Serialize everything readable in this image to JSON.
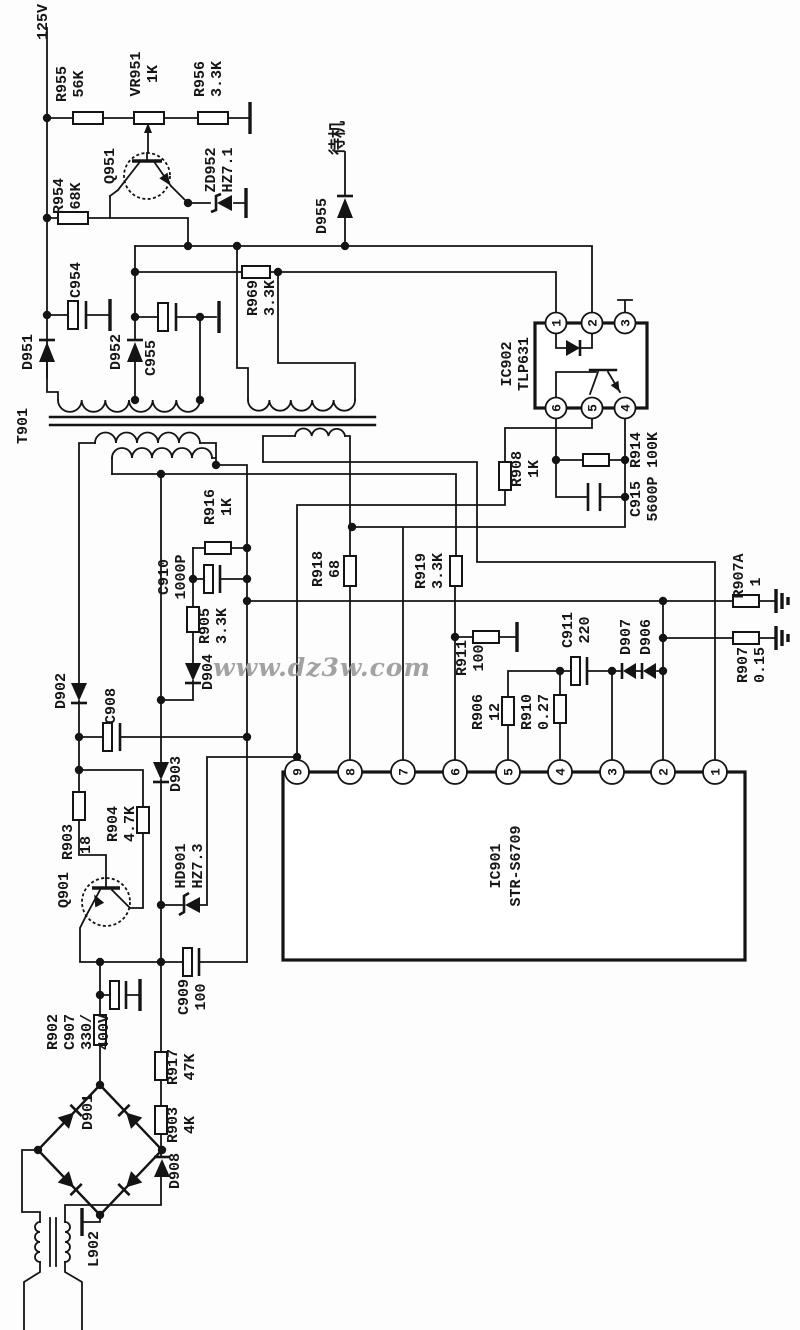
{
  "watermark": "www.dz3w.com",
  "ic901": {
    "name": "IC901",
    "part": "STR-S6709",
    "pins": [
      "9",
      "8",
      "7",
      "6",
      "5",
      "4",
      "3",
      "2",
      "1"
    ]
  },
  "ic902": {
    "name": "IC902",
    "part": "TLP631",
    "pins_top": [
      "1",
      "2",
      "3"
    ],
    "pins_bottom": [
      "6",
      "5",
      "4"
    ]
  },
  "c": {
    "v125": {
      "l1": "125V"
    },
    "r955": {
      "l1": "R955",
      "l2": "56K"
    },
    "vr951": {
      "l1": "VR951",
      "l2": "1K"
    },
    "r956": {
      "l1": "R956",
      "l2": "3.3K"
    },
    "q951": {
      "l1": "Q951"
    },
    "r954": {
      "l1": "R954",
      "l2": "68K"
    },
    "zd952": {
      "l1": "ZD952",
      "l2": "HZ7.1"
    },
    "d955": {
      "l1": "D955"
    },
    "standby": {
      "l1": "待机"
    },
    "r969": {
      "l1": "R969",
      "l2": "3.3K"
    },
    "c954": {
      "l1": "C954"
    },
    "d951": {
      "l1": "D951"
    },
    "d952": {
      "l1": "D952"
    },
    "c955": {
      "l1": "C955"
    },
    "t901": {
      "l1": "T901"
    },
    "r908": {
      "l1": "R908",
      "l2": "1K"
    },
    "r914": {
      "l1": "R914",
      "l2": "100K"
    },
    "c915": {
      "l1": "C915",
      "l2": "5600P"
    },
    "r916": {
      "l1": "R916",
      "l2": "1K"
    },
    "c910": {
      "l1": "C910",
      "l2": "1000P"
    },
    "r905": {
      "l1": "R905",
      "l2": "3.3K"
    },
    "d904": {
      "l1": "D904"
    },
    "r918": {
      "l1": "R918",
      "l2": "68"
    },
    "r919": {
      "l1": "R919",
      "l2": "3.3K"
    },
    "r911": {
      "l1": "R911",
      "l2": "100"
    },
    "c911": {
      "l1": "C911",
      "l2": "220"
    },
    "d907": {
      "l1": "D907"
    },
    "d906": {
      "l1": "D906"
    },
    "r907a": {
      "l1": "R907A",
      "l2": "1"
    },
    "r907": {
      "l1": "R907",
      "l2": "0.15"
    },
    "r906": {
      "l1": "R906",
      "l2": "12"
    },
    "r910": {
      "l1": "R910",
      "l2": "0.27"
    },
    "d902": {
      "l1": "D902"
    },
    "c908": {
      "l1": "C908"
    },
    "d903": {
      "l1": "D903"
    },
    "r903": {
      "l1": "R903",
      "l2": "18"
    },
    "r904": {
      "l1": "R904",
      "l2": "4.7K"
    },
    "hd901": {
      "l1": "HD901",
      "l2": "HZ7.3"
    },
    "q901": {
      "l1": "Q901"
    },
    "c909": {
      "l1": "C909",
      "l2": "100"
    },
    "r902": {
      "l1": "R902"
    },
    "c907": {
      "l1": "C907",
      "l2": "330/",
      "l3": "400V"
    },
    "r917": {
      "l1": "R917",
      "l2": "47K"
    },
    "r903b": {
      "l1": "R903",
      "l2": "4K"
    },
    "d908": {
      "l1": "D908"
    },
    "d901": {
      "l1": "D901"
    },
    "l902": {
      "l1": "L902"
    }
  }
}
